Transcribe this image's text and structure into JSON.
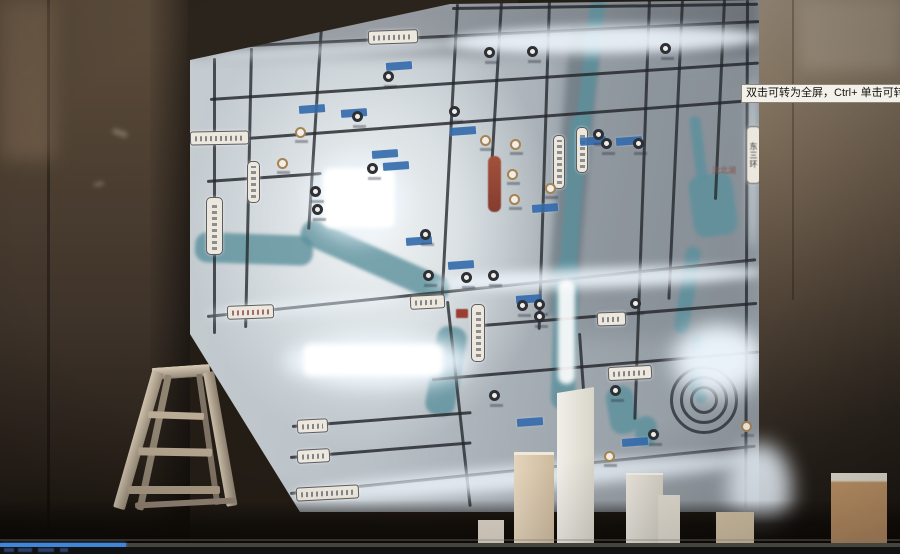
{
  "video_player": {
    "tooltip_text": "双击可转为全屏，Ctrl+ 单击可转为",
    "progress_percent": 14,
    "progress_color": "#3f85d8"
  },
  "map_wall": {
    "ring_road_sign": "东三环",
    "lake_label": "沈北湖",
    "road_color": "#23262b",
    "river_color": "#58929f",
    "glow_color": "#eef7ff",
    "sign_bg_color": "#ece8dd",
    "chip_color": "#2f6cb3"
  }
}
